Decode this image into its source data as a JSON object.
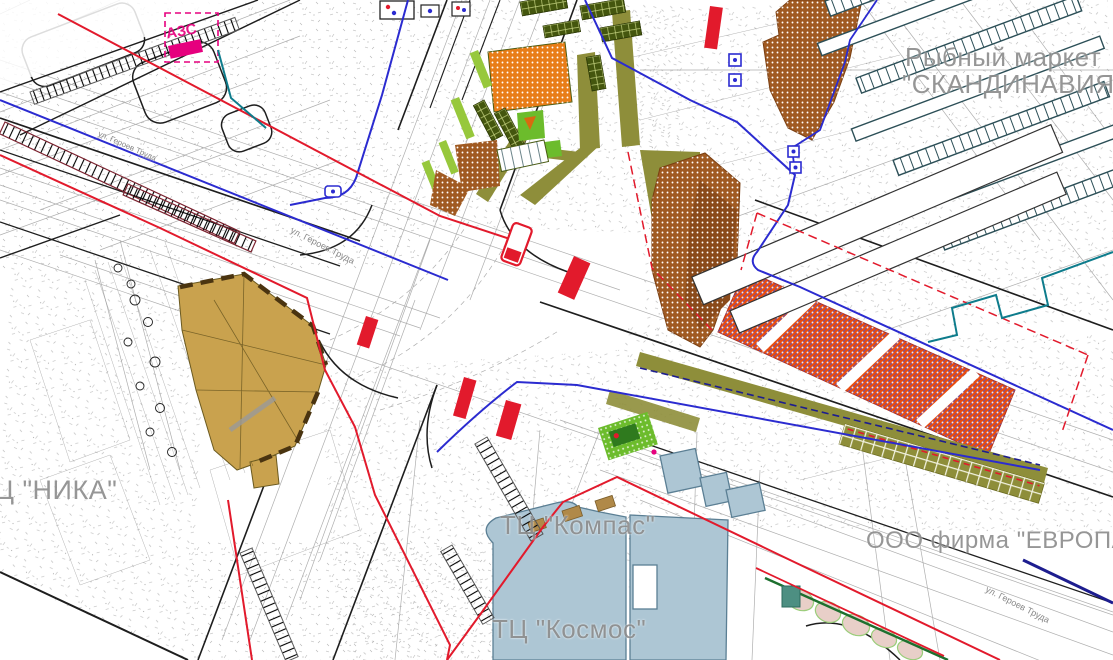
{
  "map": {
    "type": "urban-planning-cad-drawing",
    "language": "ru",
    "labels": {
      "fish_market_line1": "Рыбный маркет",
      "fish_market_line2": "\"СКАНДИНАВИЯ\"",
      "gas_station": "АЗС",
      "mall_nika": "Ц \"НИКА\"",
      "mall_kompas": "ТЦ \"Компас\"",
      "mall_kosmos": "ТЦ \"Космос\"",
      "firm_evropa": "ООО фирма \"ЕВРОПА\"",
      "street_geroev_truda": "ул. Героев Труда"
    },
    "landmarks": [
      "gas-station-AZS",
      "mall-NIKA-building",
      "fish-market-SKANDINAVIA-building",
      "market-stall-rows",
      "orange-parking-lot",
      "brown-planting-area",
      "mall-KOMPAS-buildings",
      "mall-KOSMOS-buildings",
      "firm-EVROPA-area",
      "central-road-intersection",
      "bus-stop-bars",
      "green-parking-pocket"
    ],
    "palette": {
      "background": "#ffffff",
      "linework_grey": "#9a9a9a",
      "road_black": "#1e1e1e",
      "utility_blue": "#2b2bd0",
      "utility_navy": "#1d1d8f",
      "utility_red": "#e21a2c",
      "utility_teal": "#0e7c8c",
      "boundary_magenta": "#e6007e",
      "ladder_maroon": "#7c2330",
      "building_tan": "#c9a24e",
      "building_tan_stroke": "#6b5a20",
      "building_brown": "#a05a22",
      "parking_orange": "#e84c10",
      "orange_square": "#e87d18",
      "hatch_violet": "#5b4fb8",
      "roadband_olive": "#8e8e3a",
      "parking_green_dark": "#44560e",
      "grass_light": "#97c83c",
      "grass_bright": "#6cbc2c",
      "building_pale_blue": "#adc6d4",
      "pale_blue_stroke": "#5b7f94",
      "label_grey": "#8e8e8e",
      "tree_pink": "#e8cfc8",
      "stall_outline": "#2c4f57"
    }
  }
}
